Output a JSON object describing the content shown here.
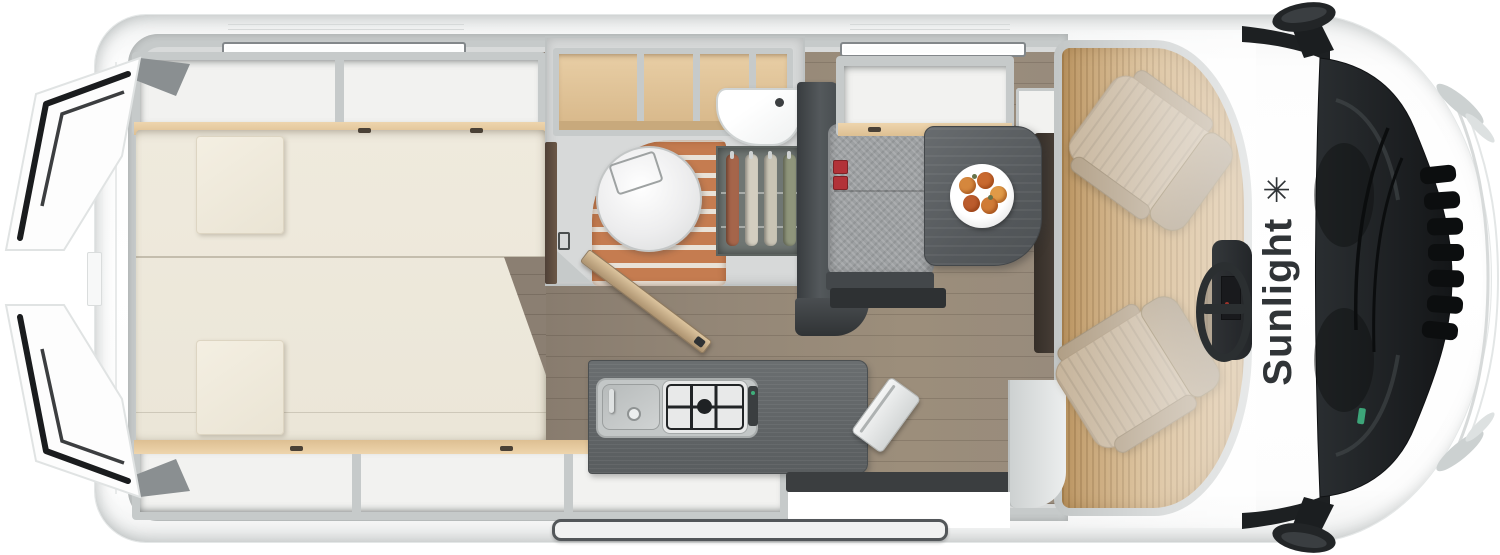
{
  "brand": {
    "name": "Sunlight",
    "logo_glyph": "✳",
    "text_color": "#303437"
  },
  "floorplan": {
    "view": "camper-van-top-down-floor-plan",
    "areas": [
      {
        "id": "rear-bed",
        "name": "transverse-rear-bed"
      },
      {
        "id": "rear-doors",
        "name": "open-rear-doors"
      },
      {
        "id": "bathroom",
        "name": "washroom-with-toilet-shower-basin-wardrobe"
      },
      {
        "id": "kitchen",
        "name": "kitchenette-sink-and-hob"
      },
      {
        "id": "dinette",
        "name": "bench-table-with-fruit-plate"
      },
      {
        "id": "entry",
        "name": "sliding-door-entry"
      },
      {
        "id": "cab",
        "name": "driver-cab-two-swivel-seats"
      }
    ],
    "colors": {
      "body_white": "#fdfdfd",
      "wall_gray": "#c6caca",
      "mattress_cream": "#ece7d9",
      "wood_trim": "#e5cba2",
      "floor_wood": "#93877a",
      "cab_floor_wood": "#c7a26b",
      "shower_slats": "#c57c50",
      "counter_dark": "#5d6163",
      "bench_gray": "#9da0a2",
      "seat_beige": "#c6b49b",
      "accent_red": "#b23238",
      "windshield_dark": "#1d2022"
    }
  }
}
